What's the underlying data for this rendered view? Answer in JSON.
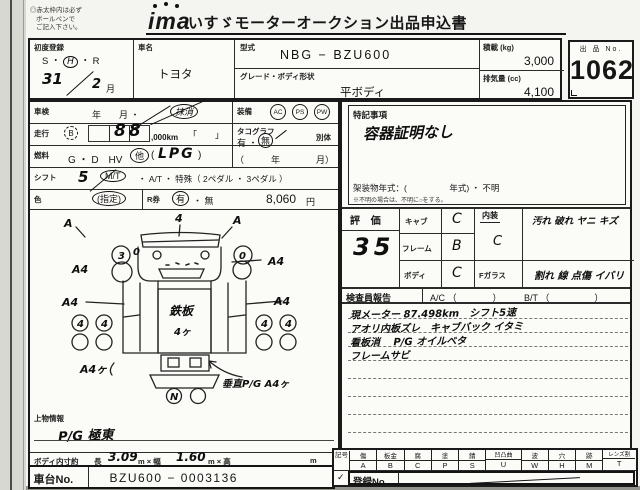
{
  "colors": {
    "ink": "#1a1a1a",
    "paper": "#f4f4f1"
  },
  "header": {
    "note1": "◎赤太枠内は必ず",
    "note2": "ボールペンで",
    "note3": "ご記入下さい。",
    "logo": "ima",
    "title": "いすゞモーターオークション出品申込書"
  },
  "lot": {
    "label": "出 品 No.",
    "number": "1062"
  },
  "top": {
    "first_reg": {
      "label": "初度登録",
      "era": "S ・",
      "era_h": "H",
      "era_r": "・ R",
      "year": "31",
      "month": "2",
      "month_unit": "月"
    },
    "car_name": {
      "label": "車名",
      "value": "トヨタ"
    },
    "model": {
      "label": "型式",
      "value": "NBG − BZU600"
    },
    "grade": {
      "label": "グレード・ボディ形状",
      "value": "平ボディ"
    },
    "payload": {
      "label": "積載 (kg)",
      "value": "3,000"
    },
    "displacement": {
      "label": "排気量 (cc)",
      "value": "4,100"
    }
  },
  "rows": {
    "shaken": {
      "label": "車検",
      "text": "年　　月 ・",
      "circled": "抹消"
    },
    "soukou": {
      "label": "走行",
      "badge": "B",
      "digits": "88",
      "unit": ",000km",
      "brackets": "「　　」"
    },
    "nenryo": {
      "label": "燃料",
      "opts": "G ・ D　HV",
      "other": "他",
      "paren_open": "(",
      "value": "LPG",
      "paren_close": ")"
    },
    "shift": {
      "label": "シフト",
      "hand": "5",
      "mt": "M/T",
      "rest": "・ A/T ・ 特殊（ 2ペダル ・ 3ペダル ）"
    },
    "color": {
      "label": "色",
      "value": "(指定)"
    },
    "rken": {
      "label": "R券",
      "yes": "有",
      "sep": "・ 無",
      "price": "8,060",
      "yen": "円"
    },
    "tacho": {
      "label": "タコグラフ",
      "yes": "有 ・",
      "no": "無",
      "sep": "別体",
      "date": "（　　　年　　　　月）"
    },
    "equip": {
      "label": "装備",
      "i1": "AC",
      "i2": "PS",
      "i3": "PW"
    }
  },
  "notes": {
    "label": "特記事項",
    "value": "容器証明なし",
    "frame": "架装物年式：(　　　　　年式) ・ 不明",
    "hint": "※不明の場合は、不明に○をする。"
  },
  "rating": {
    "label": "評 価",
    "score": "35",
    "cab": "キャブ",
    "cab_v": "C",
    "frame": "フレーム",
    "frame_v": "B",
    "body": "ボディ",
    "body_v": "C",
    "interior": "内装",
    "interior_v": "C",
    "interior_issues": "汚れ 破れ ヤニ キズ",
    "fglass": "Fガラス",
    "fglass_issues": "割れ 線 点傷 イバリ"
  },
  "inspector": {
    "label": "検査員報告",
    "ac": "A/C （　　　　）",
    "bt": "B/T （　　　　　）",
    "line1": "現メーター 87.498km　シフト5速",
    "line2": "アオリ内板ズレ　キャブバック イタミ",
    "line3": "看板消　 P/G オイルベタ",
    "line4": "フレームサビ"
  },
  "legend": {
    "label": "記号",
    "cols": [
      {
        "n": "傷",
        "c": "A"
      },
      {
        "n": "板金",
        "c": "B"
      },
      {
        "n": "腐",
        "c": "C"
      },
      {
        "n": "塗",
        "c": "P"
      },
      {
        "n": "錆",
        "c": "S"
      },
      {
        "n": "凹凸曲",
        "c": "U"
      },
      {
        "n": "波",
        "c": "W"
      },
      {
        "n": "穴",
        "c": "H"
      },
      {
        "n": "跡",
        "c": "M"
      },
      {
        "n": "レンズ割",
        "c": "T"
      }
    ]
  },
  "bottom": {
    "uwamono_label": "上物情報",
    "uwamono_value": "P/G 極東",
    "dims_label": "ボディ内寸約",
    "len_label": "長",
    "len": "3.09",
    "u1": "m × 幅",
    "wid": "1.60",
    "u2": "m × 高",
    "u3": "m",
    "chassis_label": "車台No.",
    "chassis": "BZU600 − 0003136",
    "check": "✓",
    "reg_label": "登録No."
  },
  "diagram": {
    "a1": "A",
    "t4": "4",
    "a2": "A",
    "c3": "3",
    "z1": "0",
    "z2": "0",
    "a4l1": "A4",
    "a4l2": "A4",
    "a4r1": "A4",
    "a4r2": "A4",
    "w": "4",
    "bed": "鉄板",
    "bed2": "4ヶ",
    "n": "N",
    "bl": "A4ヶ",
    "br": "垂直P/G A4ヶ"
  }
}
